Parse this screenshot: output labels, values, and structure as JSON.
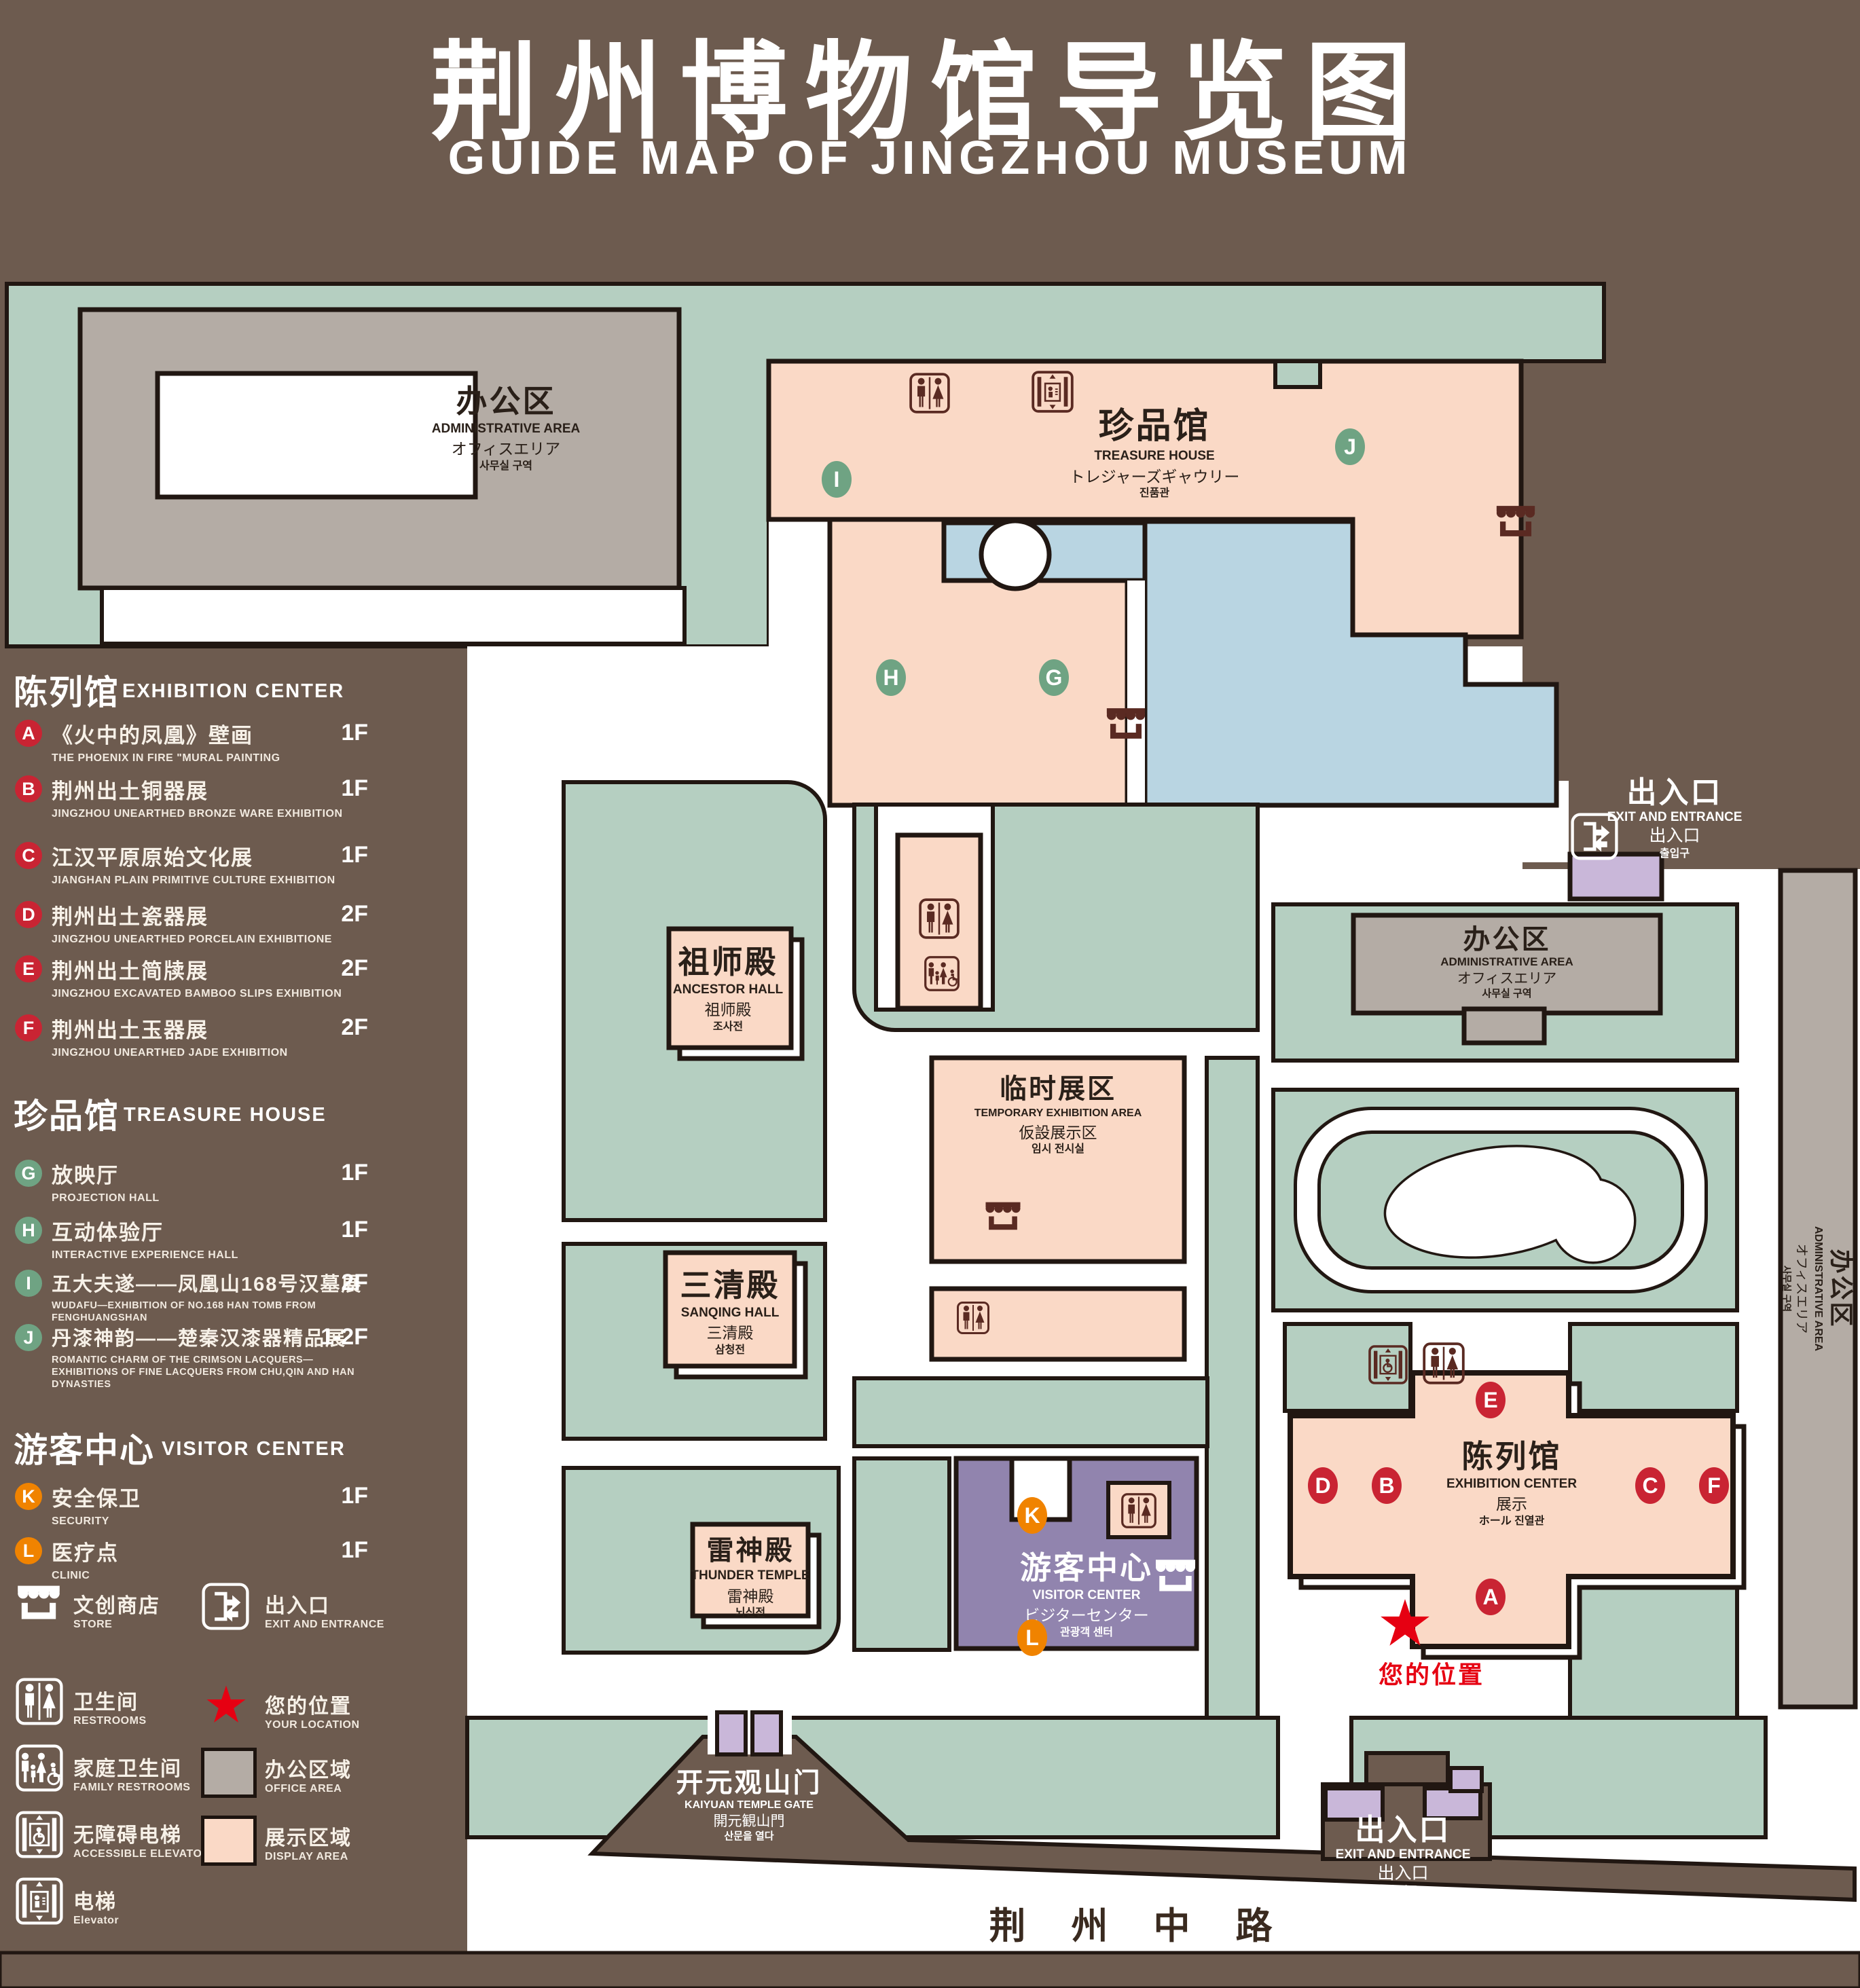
{
  "title": {
    "zh": "荆州博物馆导览图",
    "en": "GUIDE MAP OF JINGZHOU MUSEUM"
  },
  "colors": {
    "background": "#6d5b4f",
    "green": "#b5cfc1",
    "pink": "#fad9c6",
    "gray": "#b4aca5",
    "lake": "#b9d5e2",
    "purple": "#9184ae",
    "lavender": "#c9b7d9",
    "outline": "#211712",
    "icon_dark": "#5a2a22",
    "badge_red": "#c92433",
    "badge_green": "#6fa383",
    "badge_orange": "#f08300",
    "star_red": "#e60012",
    "label_dark": "#2a2019"
  },
  "legend": {
    "sections": [
      {
        "zh": "陈列馆",
        "en": "EXHIBITION CENTER",
        "items": [
          {
            "letter": "A",
            "zh": "《火中的凤凰》壁画",
            "en": "THE PHOENIX IN FIRE \"MURAL PAINTING",
            "floor": "1F"
          },
          {
            "letter": "B",
            "zh": "荆州出土铜器展",
            "en": "JINGZHOU UNEARTHED BRONZE WARE EXHIBITION",
            "floor": "1F"
          },
          {
            "letter": "C",
            "zh": "江汉平原原始文化展",
            "en": "JIANGHAN PLAIN PRIMITIVE CULTURE EXHIBITION",
            "floor": "1F"
          },
          {
            "letter": "D",
            "zh": "荆州出土瓷器展",
            "en": "JINGZHOU UNEARTHED PORCELAIN EXHIBITIONE",
            "floor": "2F"
          },
          {
            "letter": "E",
            "zh": "荆州出土简牍展",
            "en": "JINGZHOU EXCAVATED BAMBOO SLIPS EXHIBITION",
            "floor": "2F"
          },
          {
            "letter": "F",
            "zh": "荆州出土玉器展",
            "en": "JINGZHOU UNEARTHED JADE EXHIBITION",
            "floor": "2F"
          }
        ]
      },
      {
        "zh": "珍品馆",
        "en": "TREASURE HOUSE",
        "items": [
          {
            "letter": "G",
            "zh": "放映厅",
            "en": "PROJECTION HALL",
            "floor": "1F"
          },
          {
            "letter": "H",
            "zh": "互动体验厅",
            "en": "INTERACTIVE EXPERIENCE HALL",
            "floor": "1F"
          },
          {
            "letter": "I",
            "zh": "五大夫遂——凤凰山168号汉墓展",
            "en": "WUDAFU—EXHIBITION OF NO.168 HAN TOMB FROM FENGHUANGSHAN",
            "floor": "2F"
          },
          {
            "letter": "J",
            "zh": "丹漆神韵——楚秦汉漆器精品展",
            "en": "ROMANTIC CHARM OF THE CRIMSON LACQUERS—EXHIBITIONS OF FINE LACQUERS FROM CHU,QIN AND HAN DYNASTIES",
            "floor": "1-2F"
          }
        ]
      },
      {
        "zh": "游客中心",
        "en": "VISITOR CENTER",
        "items": [
          {
            "letter": "K",
            "zh": "安全保卫",
            "en": "SECURITY",
            "floor": "1F"
          },
          {
            "letter": "L",
            "zh": "医疗点",
            "en": "CLINIC",
            "floor": "1F"
          }
        ]
      }
    ],
    "symbols_left": [
      {
        "icon": "store-icon",
        "zh": "文创商店",
        "en": "STORE"
      },
      {
        "icon": "restrooms-icon",
        "zh": "卫生间",
        "en": "RESTROOMS"
      },
      {
        "icon": "family-restrooms-icon",
        "zh": "家庭卫生间",
        "en": "FAMILY RESTROOMS"
      },
      {
        "icon": "accessible-elevator-icon",
        "zh": "无障碍电梯",
        "en": "ACCESSIBLE ELEVATOR"
      },
      {
        "icon": "elevator-icon",
        "zh": "电梯",
        "en": "Elevator"
      }
    ],
    "symbols_right": [
      {
        "icon": "exit-icon",
        "zh": "出入口",
        "en": "EXIT AND ENTRANCE"
      },
      {
        "icon": "location-star-icon",
        "zh": "您的位置",
        "en": "YOUR LOCATION"
      },
      {
        "icon": "office-area-swatch",
        "zh": "办公区域",
        "en": "OFFICE AREA"
      },
      {
        "icon": "display-area-swatch",
        "zh": "展示区域",
        "en": "DISPLAY AREA"
      }
    ]
  },
  "map": {
    "buildings": {
      "admin_nw": {
        "lines": [
          "办公区",
          "ADMINISTRATIVE AREA",
          "オフィスエリア",
          "사무실 구역"
        ]
      },
      "treasure_house": {
        "lines": [
          "珍品馆",
          "TREASURE HOUSE",
          "トレジャーズギャウリー",
          "진품관"
        ]
      },
      "ancestor_hall": {
        "lines": [
          "祖师殿",
          "ANCESTOR HALL",
          "祖师殿",
          "조사전"
        ]
      },
      "sanqing_hall": {
        "lines": [
          "三清殿",
          "SANQING HALL",
          "三清殿",
          "삼청전"
        ]
      },
      "thunder_temple": {
        "lines": [
          "雷神殿",
          "THUNDER TEMPLE",
          "雷神殿",
          "뇌신전"
        ]
      },
      "temporary_exhibition": {
        "lines": [
          "临时展区",
          "TEMPORARY EXHIBITION AREA",
          "仮設展示区",
          "임시 전시실"
        ]
      },
      "visitor_center": {
        "lines": [
          "游客中心",
          "VISITOR CENTER",
          "ビジターセンター",
          "관광객 센터"
        ]
      },
      "admin_mid": {
        "lines": [
          "办公区",
          "ADMINISTRATIVE AREA",
          "オフィスエリア",
          "사무실 구역"
        ]
      },
      "admin_east": {
        "lines": [
          "办公区",
          "ADMINISTRATIVE AREA",
          "オフィスエリア",
          "사무실 구역"
        ]
      },
      "exhibition_center": {
        "lines": [
          "陈列馆",
          "EXHIBITION CENTER",
          "展示",
          "ホール 진열관"
        ]
      }
    },
    "gate": {
      "lines": [
        "开元观山门",
        "KAIYUAN TEMPLE GATE",
        "開元観山門",
        "산문을 열다"
      ]
    },
    "exit_ne": {
      "lines": [
        "出入口",
        "EXIT AND ENTRANCE",
        "出入口",
        "출입구"
      ]
    },
    "exit_s": {
      "lines": [
        "出入口",
        "EXIT AND ENTRANCE",
        "出入口",
        "출입구"
      ]
    },
    "road": "荆 州 中 路",
    "your_location": "您的位置",
    "badges": {
      "A": "A",
      "B": "B",
      "C": "C",
      "D": "D",
      "E": "E",
      "F": "F",
      "G": "G",
      "H": "H",
      "I": "I",
      "J": "J",
      "K": "K",
      "L": "L"
    }
  }
}
